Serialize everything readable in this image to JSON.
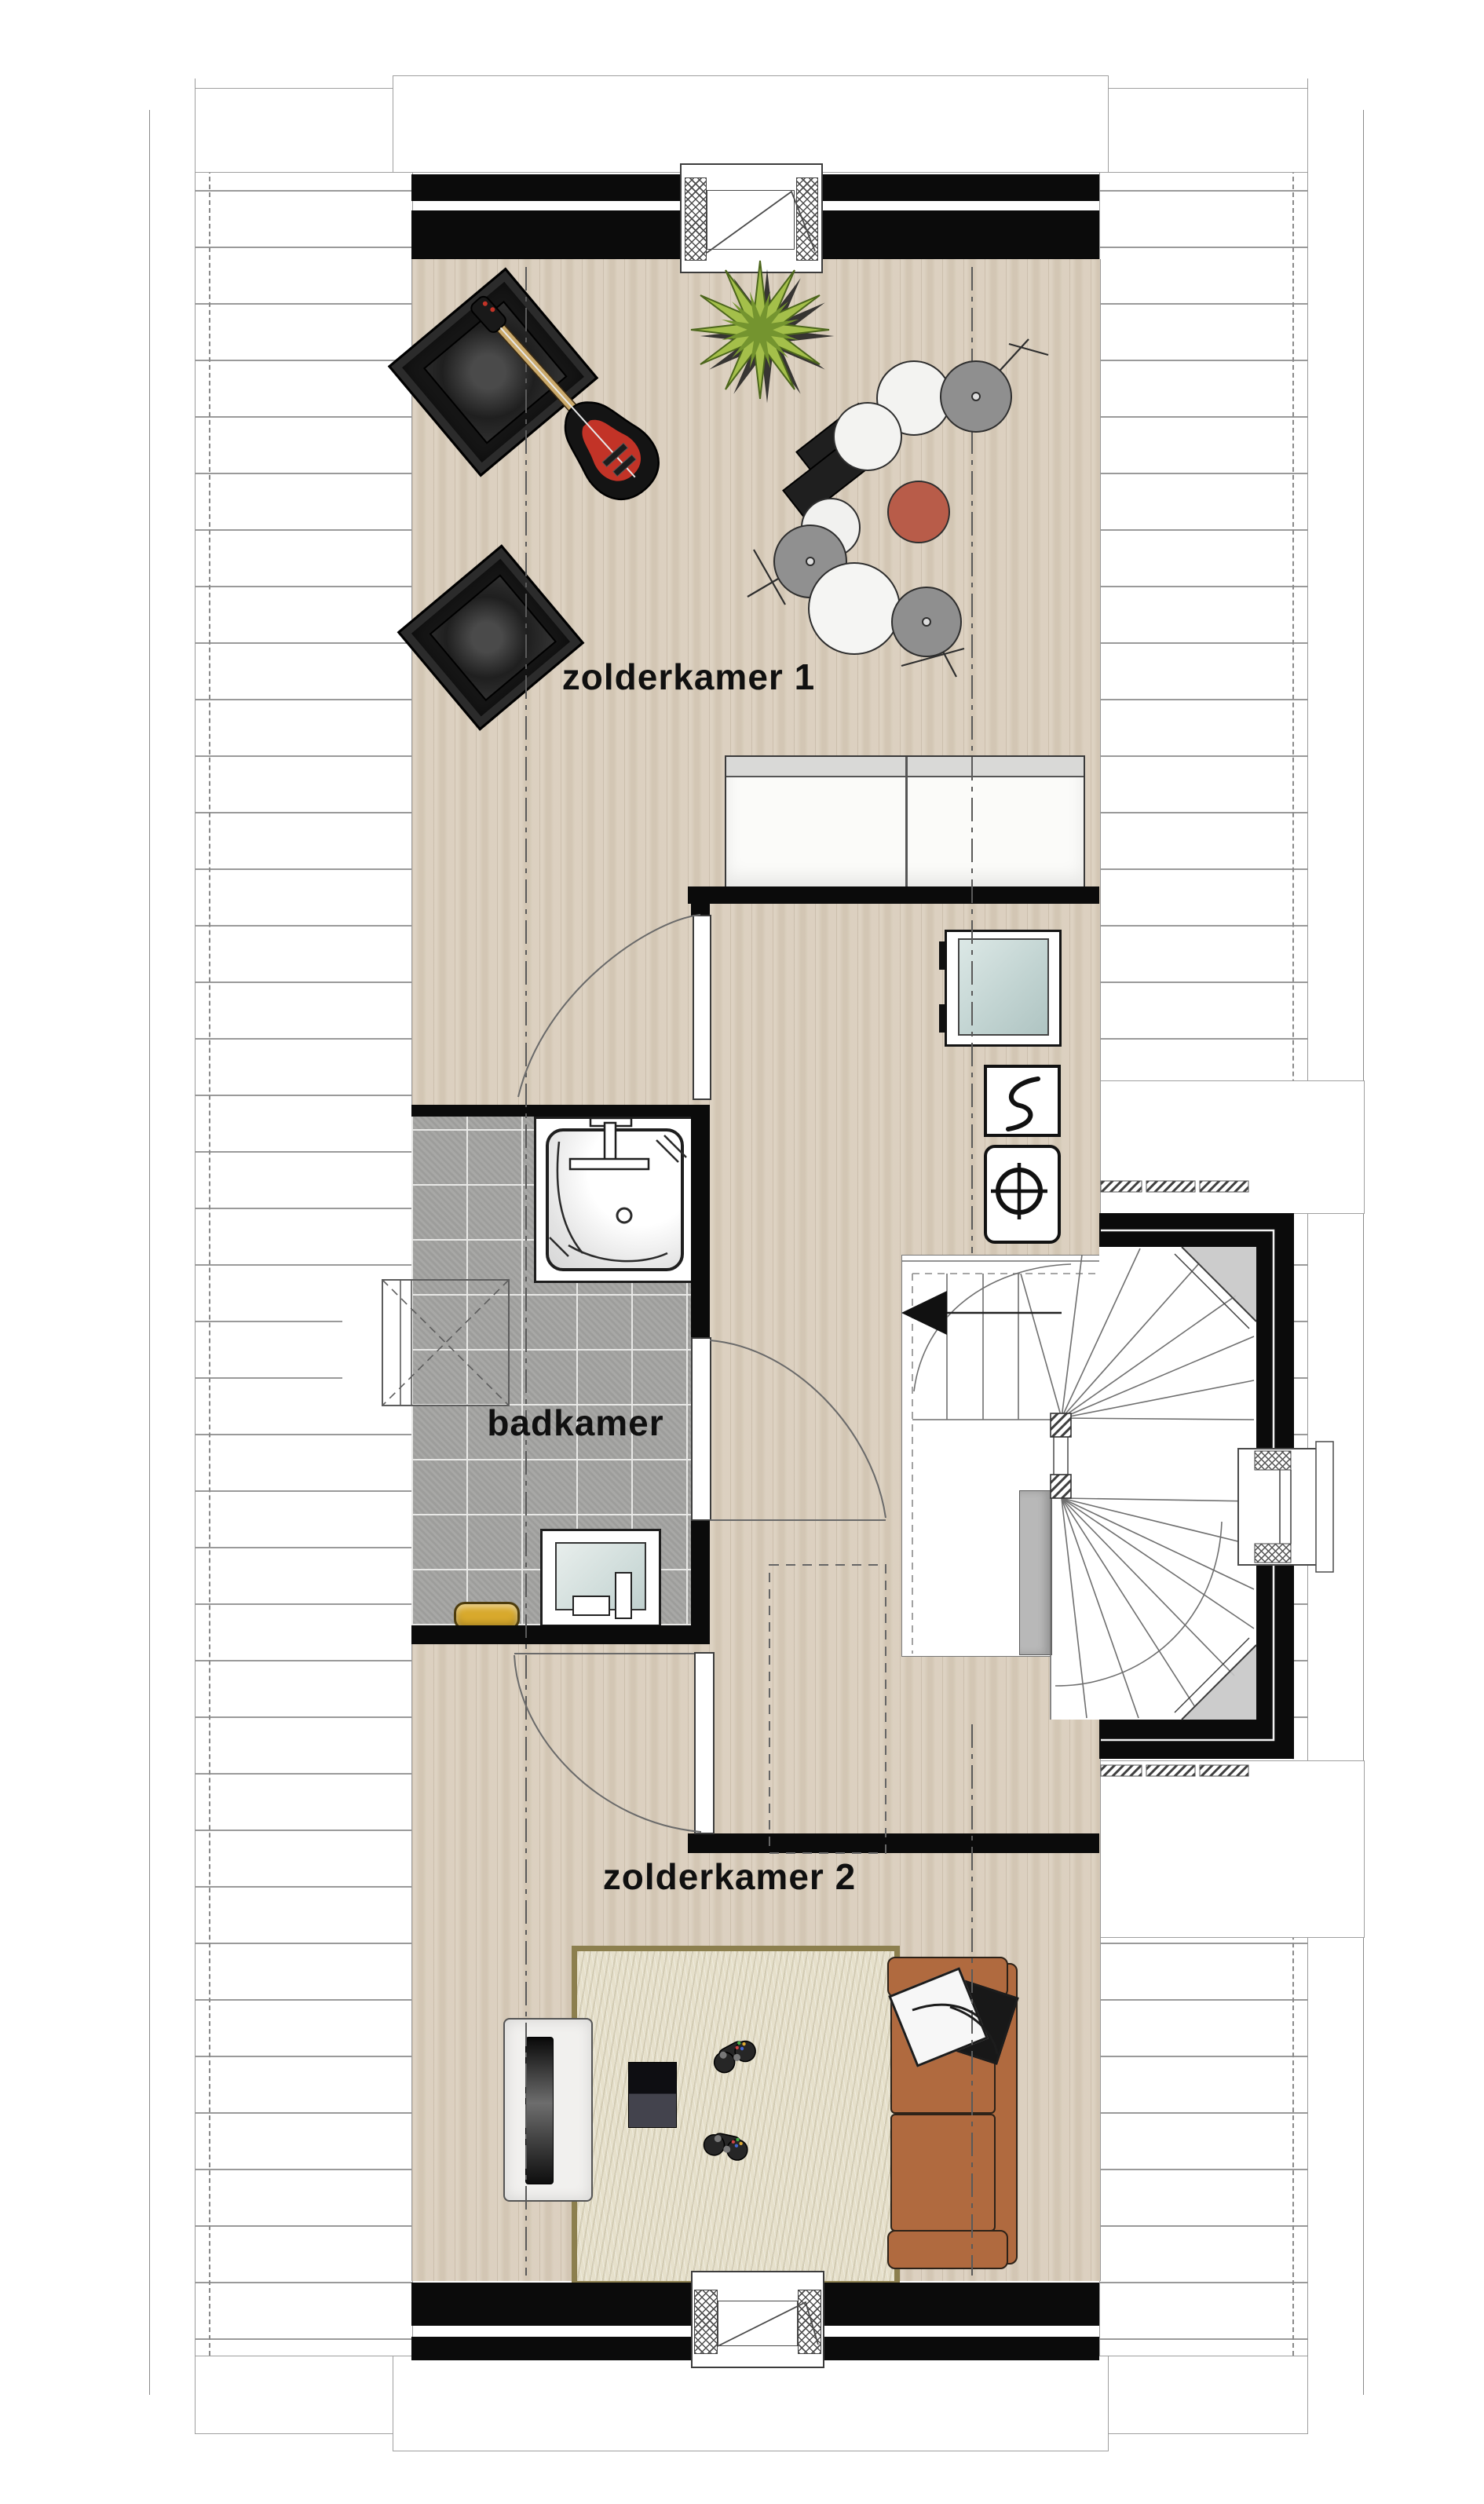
{
  "plan": {
    "title_labels": {
      "room1": "zolderkamer 1",
      "bathroom": "badkamer",
      "room2": "zolderkamer 2"
    },
    "rooms": [
      {
        "name": "attic room 1",
        "label": "zolderkamer 1",
        "fixtures": [
          "speaker-amp",
          "speaker-amp",
          "electric-guitar",
          "plant",
          "drum-kit",
          "wardrobe"
        ]
      },
      {
        "name": "bathroom",
        "label": "badkamer",
        "fixtures": [
          "shower",
          "washbasin",
          "towel-bench",
          "roof-window"
        ]
      },
      {
        "name": "landing-hall",
        "label": "",
        "fixtures": [
          "washing-machine",
          "mechanical-ventilation-unit",
          "boiler-unit",
          "winder-staircase",
          "bay-window"
        ]
      },
      {
        "name": "attic room 2",
        "label": "zolderkamer 2",
        "fixtures": [
          "tv-cabinet",
          "tv",
          "game-console",
          "game-controller",
          "game-controller",
          "rug",
          "sofa",
          "pillows"
        ]
      }
    ],
    "colors": {
      "wall": "#0b0b0b",
      "wood_floor": "#d9cdbb",
      "tile_floor": "#a3a3a1",
      "rug": "#e6e0cb",
      "rug_border": "#8c7f4e",
      "sofa": "#b06a3f",
      "drum_stool": "#b85c49",
      "cymbal": "#8f8f8f",
      "plant_green": "#a4bf4a",
      "towel_yellow": "#d8a92c",
      "glass_blue": "#cfe0de",
      "roof_line_gray": "#9a9a9a"
    },
    "stair_direction_icon": "arrow-left"
  }
}
